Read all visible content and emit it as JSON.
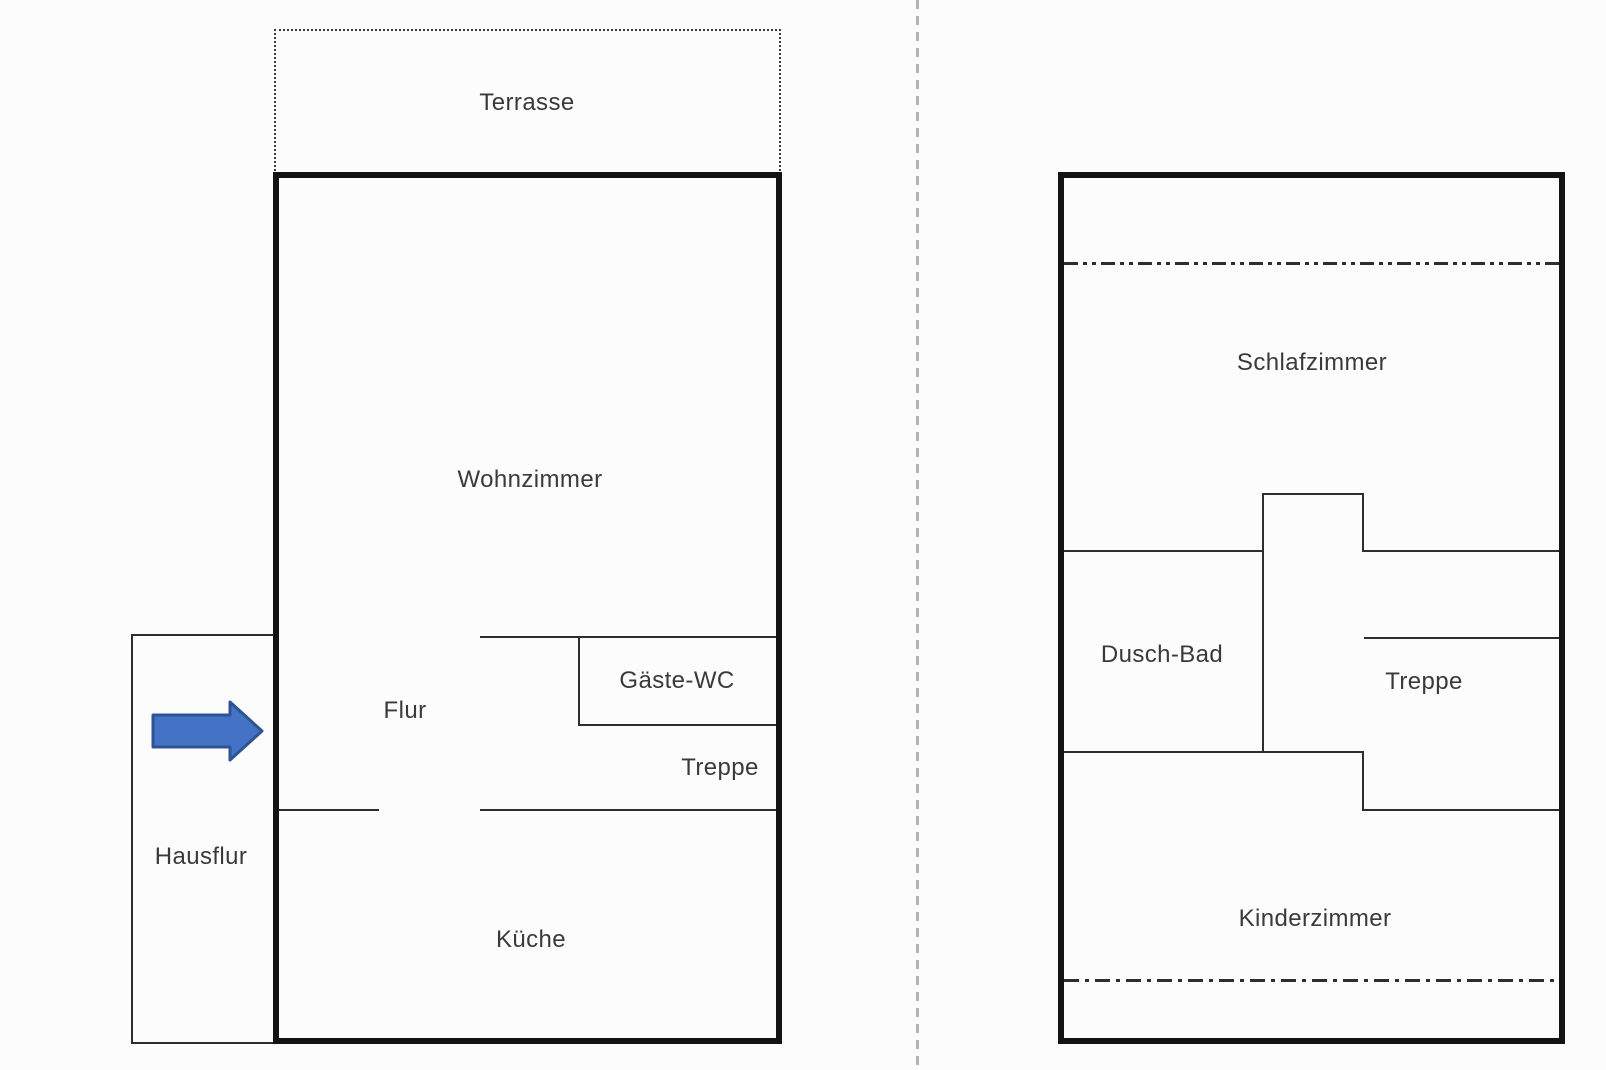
{
  "page": {
    "background": "#fcfcfc",
    "divider_color": "#b4b4b8"
  },
  "left_plan": {
    "terrasse": {
      "label": "Terrasse"
    },
    "rooms": {
      "wohnzimmer": "Wohnzimmer",
      "flur": "Flur",
      "gaeste_wc": "Gäste-WC",
      "treppe": "Treppe",
      "kueche": "Küche",
      "hausflur": "Hausflur"
    },
    "entrance_arrow": {
      "fill": "#4472c4",
      "stroke": "#2f5496"
    }
  },
  "right_plan": {
    "rooms": {
      "schlafzimmer": "Schlafzimmer",
      "dusch_bad": "Dusch-Bad",
      "treppe": "Treppe",
      "kinderzimmer": "Kinderzimmer"
    }
  },
  "colors": {
    "outer_wall": "#141414",
    "inner_wall": "#2e2e2e",
    "text": "#3a3a3a"
  }
}
